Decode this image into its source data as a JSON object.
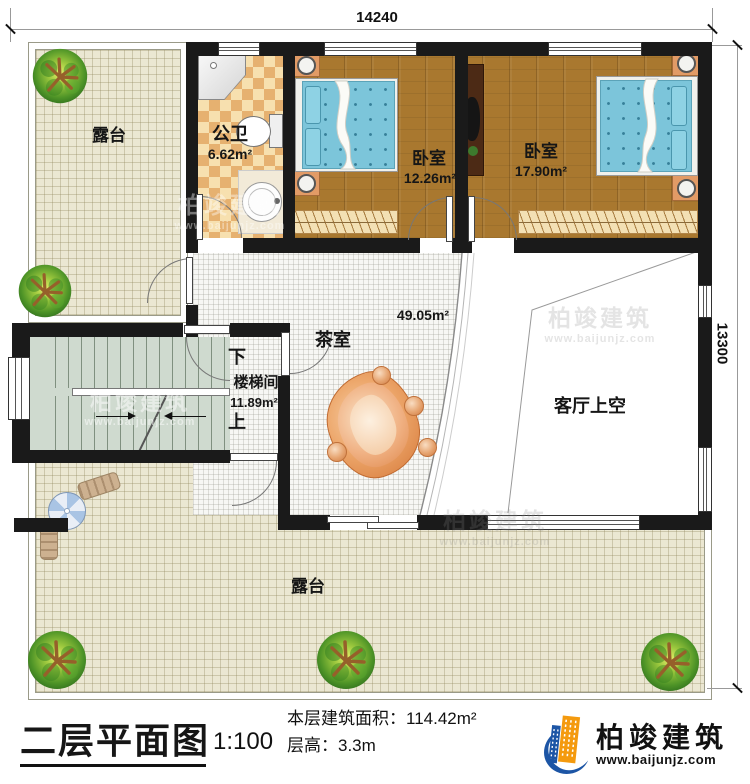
{
  "plan": {
    "dimensions": {
      "width_mm": "14240",
      "height_mm": "13300"
    },
    "rooms": {
      "terrace_top": {
        "name": "露台"
      },
      "bathroom": {
        "name": "公卫",
        "area": "6.62m²"
      },
      "bedroom_left": {
        "name": "卧室",
        "area": "12.26m²"
      },
      "bedroom_right": {
        "name": "卧室",
        "area": "17.90m²"
      },
      "tea_room": {
        "name": "茶室",
        "area": "49.05m²"
      },
      "stairwell": {
        "name": "楼梯间",
        "area": "11.89m²",
        "down_label": "下",
        "up_label": "上"
      },
      "living_room_void": {
        "name": "客厅上空"
      },
      "terrace_bottom": {
        "name": "露台"
      }
    }
  },
  "title_block": {
    "title": "二层平面图",
    "scale": "1:100",
    "area_label": "本层建筑面积：",
    "area_value": "114.42m²",
    "height_label": "层高：",
    "height_value": "3.3m"
  },
  "branding": {
    "company_name": "柏竣建筑",
    "website": "www.baijunjz.com"
  },
  "watermark": {
    "text": "柏竣建筑",
    "website": "www.baijunjz.com"
  },
  "colors": {
    "wall": "#1a1a1a",
    "wood": "#a9782f",
    "terrace": "#ebe7d2",
    "tile_light": "#f7e0af",
    "tile_dark": "#e6b170",
    "stair": "#cfdacf",
    "bed": "#7cc5da",
    "furn": "#e29b66",
    "table": "#e0803f",
    "logo_blue": "#1c55a5",
    "logo_orange": "#f49a0e"
  }
}
